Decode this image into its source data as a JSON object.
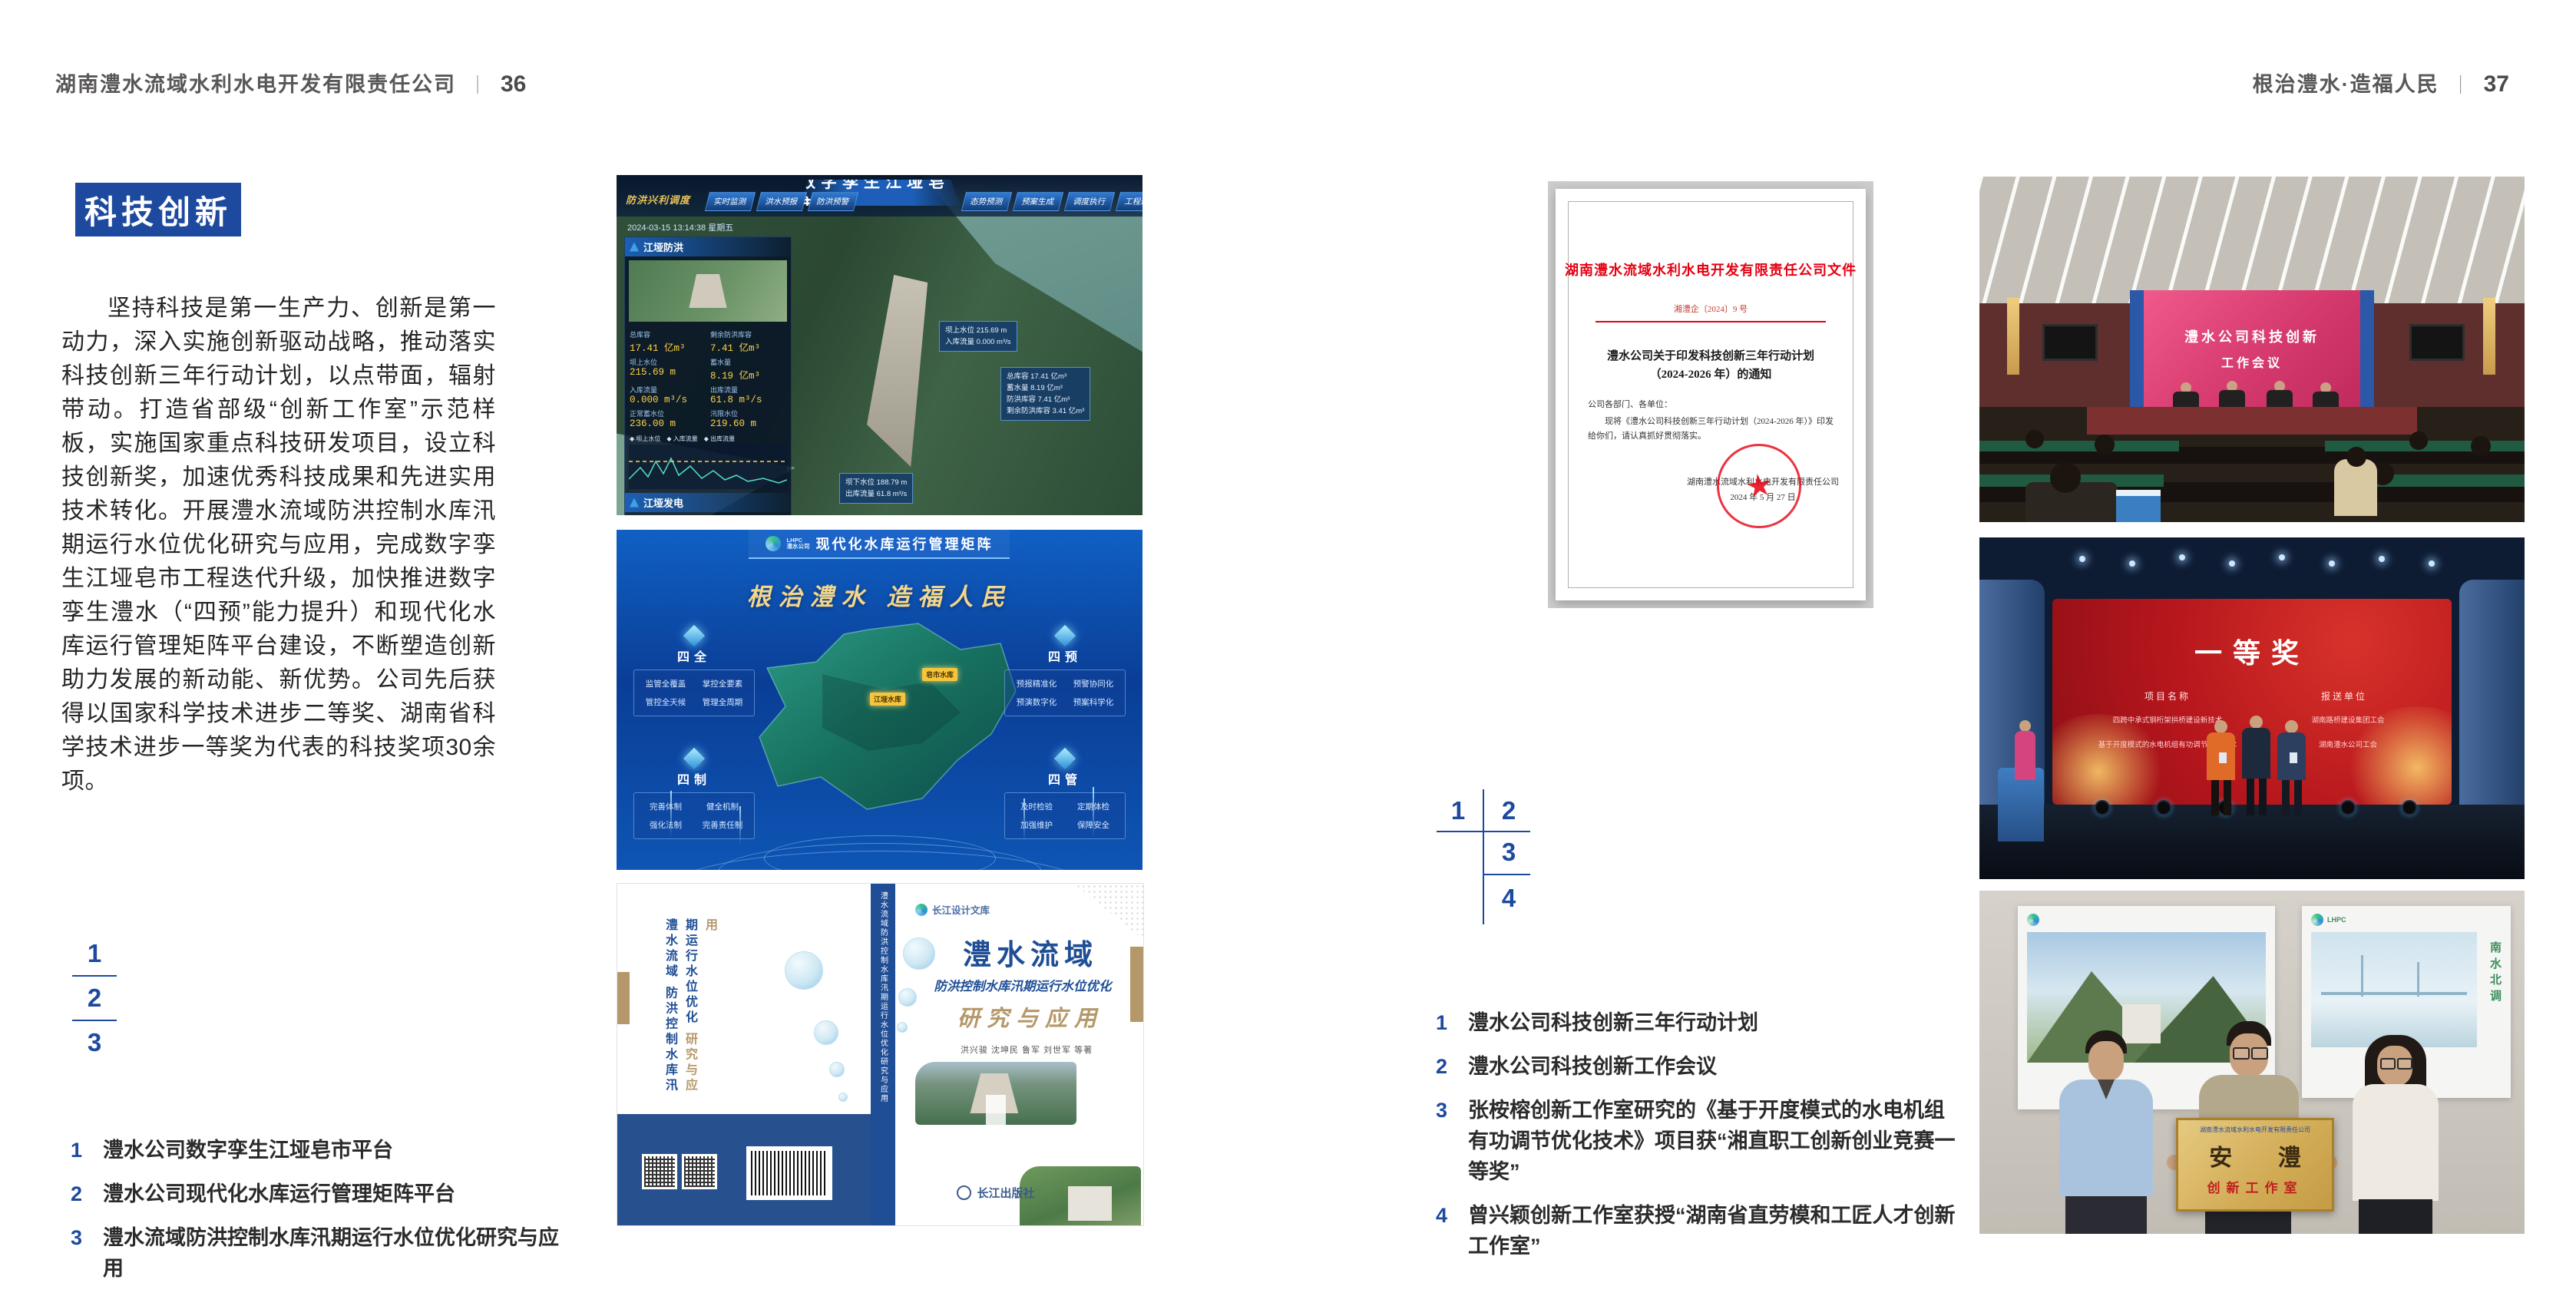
{
  "colors": {
    "accent_blue": "#1d4a9e",
    "doc_red": "#e60012",
    "gold": "#b5986a",
    "header_gray": "#595757"
  },
  "left_page": {
    "header_company": "湖南澧水流域水利水电开发有限责任公司",
    "header_sep": "｜",
    "header_page": "36",
    "badge": "科技创新",
    "paragraph": "坚持科技是第一生产力、创新是第一动力，深入实施创新驱动战略，推动落实科技创新三年行动计划，以点带面，辐射带动。打造省部级“创新工作室”示范样板，实施国家重点科技研发项目，设立科技创新奖，加速优秀科技成果和先进实用技术转化。开展澧水流域防洪控制水库汛期运行水位优化研究与应用，完成数字孪生江垭皂市工程迭代升级，加快推进数字孪生澧水（“四预”能力提升）和现代化水库运行管理矩阵平台建设，不断塑造创新助力发展的新动能、新优势。公司先后获得以国家科学技术进步二等奖、湖南省科学技术进步一等奖为代表的科技奖项30余项。",
    "index": [
      "1",
      "2",
      "3"
    ],
    "captions": [
      {
        "num": "1",
        "text": "澧水公司数字孪生江垭皂市平台"
      },
      {
        "num": "2",
        "text": "澧水公司现代化水库运行管理矩阵平台"
      },
      {
        "num": "3",
        "text": "澧水流域防洪控制水库汛期运行水位优化研究与应用"
      }
    ]
  },
  "right_page": {
    "header_title": "根治澧水·造福人民",
    "header_sep": "｜",
    "header_page": "37",
    "index": [
      "1",
      "2",
      "3",
      "4"
    ],
    "captions": [
      {
        "num": "1",
        "text": "澧水公司科技创新三年行动计划"
      },
      {
        "num": "2",
        "text": "澧水公司科技创新工作会议"
      },
      {
        "num": "3",
        "text": "张桉榕创新工作室研究的《基于开度模式的水电机组有功调节优化技术》项目获“湘直职工创新创业竞赛一等奖”"
      },
      {
        "num": "4",
        "text": "曾兴颖创新工作室获授“湖南省直劳模和工匠人才创新工作室”"
      }
    ]
  },
  "fig_dash": {
    "corner_label": "防洪兴利调度",
    "title": "数字孪生江垭皂市",
    "tabs_left": [
      "实时监测",
      "洪水预报",
      "防洪预警"
    ],
    "tabs_right": [
      "态势预测",
      "预案生成",
      "调度执行",
      "工程巡检"
    ],
    "timestamp": "2024-03-15 13:14:38 星期五",
    "panel1_title": "江垭防洪",
    "legend": "◆ 坝上水位　◆ 入库流量　◆ 出库流量",
    "stats": [
      {
        "l": "总库容",
        "v": "17.41 亿m³"
      },
      {
        "l": "剩余防洪库容",
        "v": "7.41 亿m³"
      },
      {
        "l": "坝上水位",
        "v": "215.69 m"
      },
      {
        "l": "蓄水量",
        "v": "8.19 亿m³"
      },
      {
        "l": "入库流量",
        "v": "0.000 m³/s"
      },
      {
        "l": "出库流量",
        "v": "61.8 m³/s"
      },
      {
        "l": "正常蓄水位",
        "v": "236.00 m"
      },
      {
        "l": "汛限水位",
        "v": "219.60 m"
      }
    ],
    "panel2_title": "江垭发电",
    "stats2": [
      {
        "l": "年发电量",
        "v": "6.3000 亿度"
      },
      {
        "l": "年累计发电量",
        "v": "1.2907 亿度"
      },
      {
        "l": "月累计发电量",
        "v": "3359.21 万度"
      },
      {
        "l": "当前出力",
        "v": "0.00 MW"
      }
    ],
    "chip_top": [
      "坝上水位 215.69 m",
      "入库流量 0.000 m³/s"
    ],
    "chip_right": [
      "总库容 17.41 亿m³",
      "蓄水量 8.19 亿m³",
      "防洪库容 7.41 亿m³",
      "剩余防洪库容 3.41 亿m³"
    ],
    "chip_bottom": [
      "坝下水位 188.79 m",
      "出库流量 61.8 m³/s"
    ]
  },
  "fig_matrix": {
    "logo_line1": "LHPC",
    "logo_line2": "澧水公司",
    "title": "现代化水库运行管理矩阵",
    "slogan": "根治澧水 造福人民",
    "panels": [
      {
        "name": "四全",
        "items": [
          "监管全覆盖",
          "掌控全要素",
          "管控全天候",
          "管理全周期"
        ]
      },
      {
        "name": "四制",
        "items": [
          "完善体制",
          "健全机制",
          "强化法制",
          "完善责任制"
        ]
      },
      {
        "name": "四预",
        "items": [
          "预报精准化",
          "预警协同化",
          "预演数字化",
          "预案科学化"
        ]
      },
      {
        "name": "四管",
        "items": [
          "及时检验",
          "定期体检",
          "加强维护",
          "保障安全"
        ]
      }
    ],
    "markers": [
      "皂市水库",
      "江垭水库"
    ]
  },
  "fig_book": {
    "brand": "长江设计文库",
    "back1": "澧水流域",
    "back2": "防洪控制水库汛期运行水位优化",
    "back3": "研究与应用",
    "spine": "澧水流域防洪控制水库汛期运行水位优化研究与应用",
    "title1": "澧水流域",
    "title2": "防洪控制水库汛期运行水位优化",
    "title3": "研究与应用",
    "authors": "洪兴骏 沈坤民 鲁军 刘世军 等著",
    "publisher": "长江出版社"
  },
  "fig_doc": {
    "header": "湖南澧水流域水利水电开发有限责任公司文件",
    "doc_no": "湘澧企〔2024〕9 号",
    "title1": "澧水公司关于印发科技创新三年行动计划",
    "title2": "（2024-2026 年）的通知",
    "salutation": "公司各部门、各单位：",
    "body": "现将《澧水公司科技创新三年行动计划（2024-2026 年）》印发给你们，请认真抓好贯彻落实。",
    "signer": "湖南澧水流域水利水电开发有限责任公司",
    "date": "2024 年 5 月 27 日",
    "seal_star": "★"
  },
  "fig_meeting": {
    "screen_line1": "澧水公司科技创新",
    "screen_line2": "工作会议"
  },
  "fig_award": {
    "title": "一等奖",
    "col1_header": "项目名称",
    "col2_header": "报送单位",
    "col1": [
      "四跨中承式钢桁架拱桥建设新技术",
      "基于开度模式的水电机组有功调节优化技术"
    ],
    "col2": [
      "湖南路桥建设集团工会",
      "湖南澧水公司工会"
    ]
  },
  "fig_group": {
    "plaque_top": "湖南澧水流域水利水电开发有限责任公司",
    "plaque_main": "安 澧",
    "plaque_sub": "创新工作室",
    "poster_right_text": "南水北调"
  }
}
